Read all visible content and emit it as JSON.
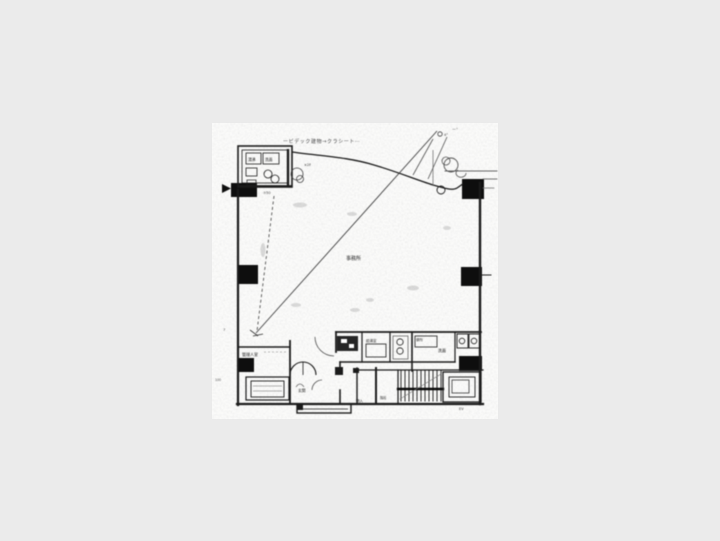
{
  "colors": {
    "background": "#ebebeb",
    "paper": "#fbfbfa",
    "ink": "#1b1b1b",
    "ink_light": "#555555"
  },
  "floorplan": {
    "annotations": {
      "top_note": "ービデック建物→クラシート⋯",
      "top_right_note": "ー⌝",
      "angle_note": "4°",
      "level_note": "⑦50",
      "corridor_note": "×2F"
    },
    "labels": {
      "center_room": "事務所",
      "manager_room": "管理人室",
      "unit_sink": "湯沸",
      "unit_wash": "洗面",
      "pantry": "給湯室",
      "toilet": "便所",
      "washstand": "洗面",
      "entrance": "玄関",
      "stairs": "階段",
      "storage": "物入",
      "elevator": "EV"
    },
    "dimensions": {
      "left_tick_upper": "7",
      "left_tick_lower": "100"
    }
  }
}
